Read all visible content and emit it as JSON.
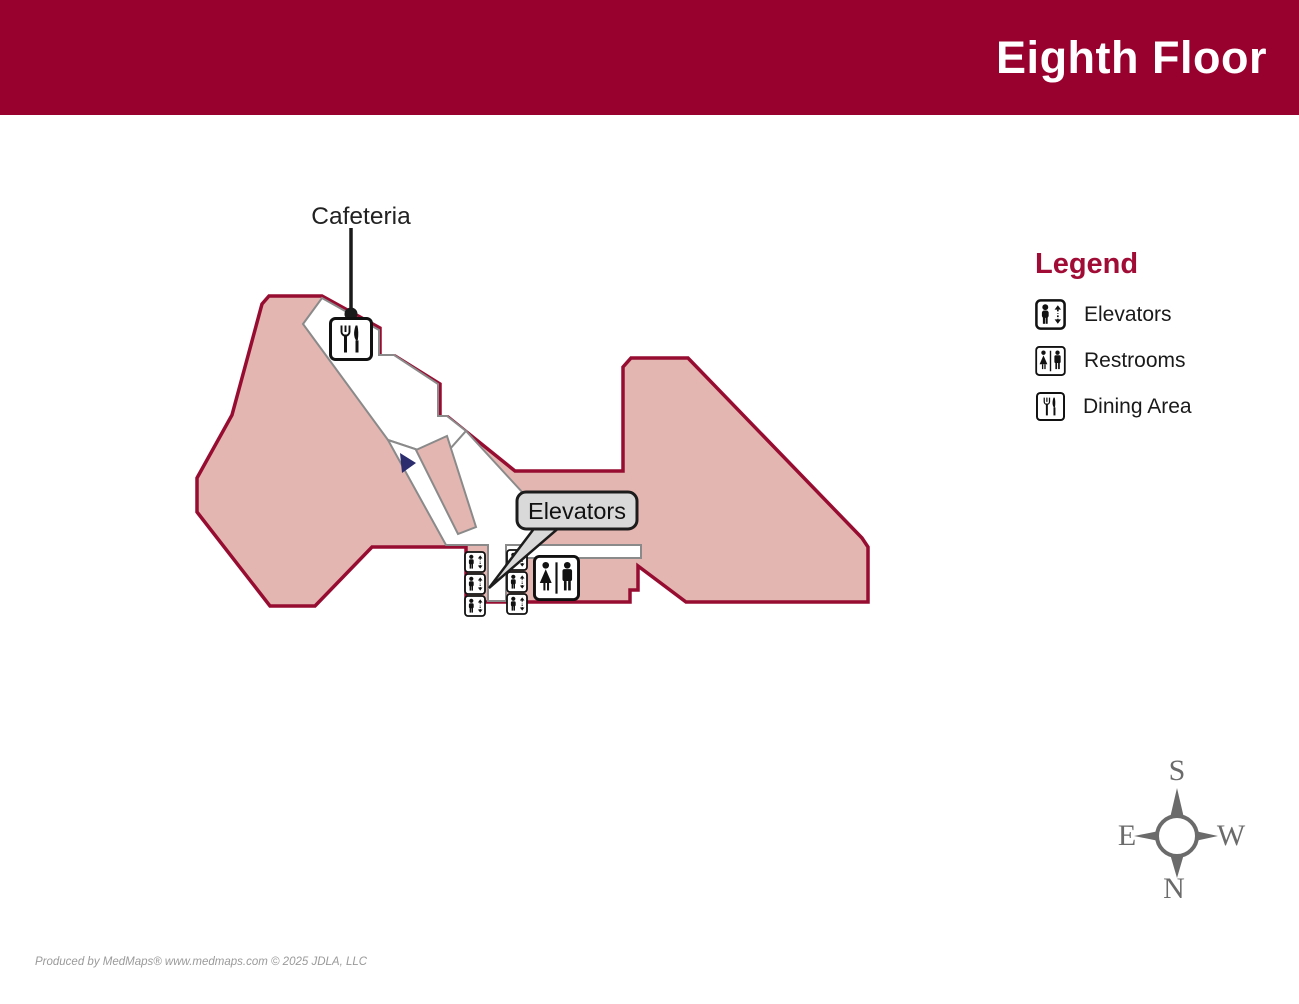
{
  "header": {
    "title": "Eighth Floor"
  },
  "map": {
    "cafeteria_label": "Cafeteria",
    "elevators_callout": "Elevators",
    "icons": {
      "elevator": "elevator-icon",
      "restroom": "restroom-icon",
      "dining": "dining-icon",
      "direction_marker": "blue-triangle-marker"
    }
  },
  "legend": {
    "title": "Legend",
    "items": [
      {
        "icon": "elevator-icon",
        "label": "Elevators"
      },
      {
        "icon": "restroom-icon",
        "label": "Restrooms"
      },
      {
        "icon": "dining-icon",
        "label": "Dining Area"
      }
    ]
  },
  "compass": {
    "top": "S",
    "bottom": "N",
    "left": "E",
    "right": "W"
  },
  "footer": {
    "credit": "Produced by MedMaps®  www.medmaps.com  © 2025 JDLA, LLC"
  },
  "colors": {
    "header_bg": "#98002e",
    "header_text": "#ffffff",
    "area_fill": "#e4b6b1",
    "area_outline": "#970d32",
    "corridor_fill": "#ffffff",
    "corridor_stroke": "#8a8a8a",
    "callout_fill": "#d9d9d9",
    "callout_border": "#1c1c1c",
    "icon_ink": "#111111",
    "marker_blue": "#2b2d6e",
    "legend_title": "#a00c35",
    "compass_gray": "#6b6b6b"
  }
}
